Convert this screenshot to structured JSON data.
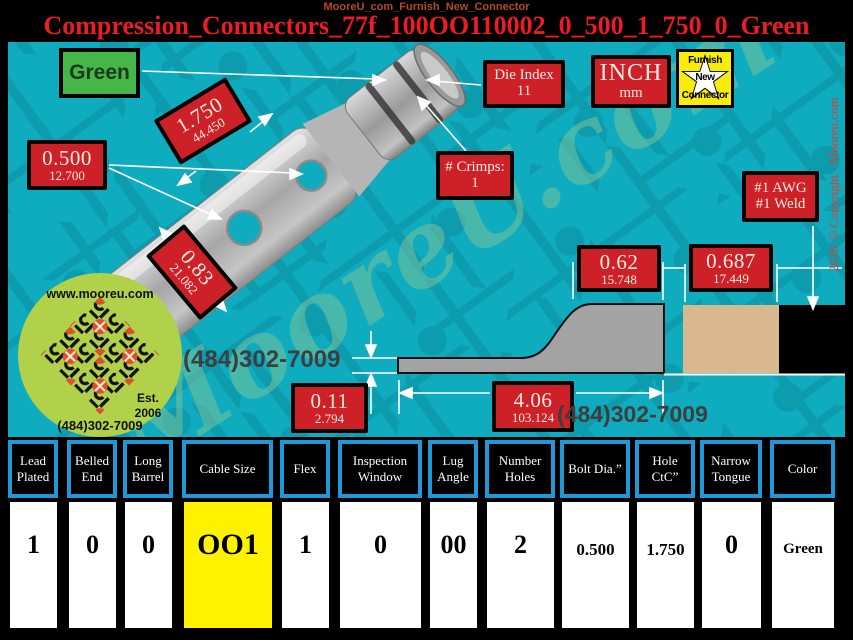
{
  "header": {
    "breadcrumb": "MooreU_com_Furnish_New_Connector",
    "title": "Compression_Connectors_77f_100OO110002_0_500_1_750_0_Green"
  },
  "canvas": {
    "green_button_label": "Green",
    "furnish_button": {
      "line1": "Furnish",
      "line2": "New",
      "line3": "Connector"
    },
    "labels": {
      "bolt_dia": {
        "in": "0.500",
        "mm": "12.700"
      },
      "hole_ctc": {
        "in": "1.750",
        "mm": "44.450"
      },
      "tongue_width": {
        "in": "0.83",
        "mm": "21.082"
      },
      "die_index": {
        "line1": "Die Index",
        "line2": "11"
      },
      "units": {
        "line1": "INCH",
        "line2": "mm"
      },
      "crimps": {
        "line1": "# Crimps:",
        "line2": "1"
      },
      "awg": {
        "line1": "#1 AWG",
        "line2": "#1 Weld"
      },
      "pad_height": {
        "in": "0.62",
        "mm": "15.748"
      },
      "barrel_od": {
        "in": "0.687",
        "mm": "17.449"
      },
      "tongue_thickness": {
        "in": "0.11",
        "mm": "2.794"
      },
      "overall_length": {
        "in": "4.06",
        "mm": "103.124"
      }
    },
    "phone1": "(484)302-7009",
    "phone2": "(484)302-7009",
    "watermark": "MooreU.com",
    "copyright": "2018 ©Copyright - Mooreu.com",
    "logo": {
      "url": "www.mooreu.com",
      "est": "Est.",
      "year": "2006",
      "phone": "(484)302-7009"
    }
  },
  "colors": {
    "canvas_teal": "#0fabbf",
    "label_red": "#ce2127",
    "title_red": "#ec1c24",
    "button_green": "#46b649",
    "highlight_yellow": "#fff200",
    "table_border_blue": "#1f98d8",
    "logo_green": "#b2d14b",
    "barrel_tan": "#d8b88c"
  },
  "table": {
    "columns": [
      {
        "label": "Lead Plated",
        "value": "1"
      },
      {
        "label": "Belled End",
        "value": "0"
      },
      {
        "label": "Long Barrel",
        "value": "0"
      },
      {
        "label": "Cable Size",
        "value": "OO1"
      },
      {
        "label": "Flex",
        "value": "1"
      },
      {
        "label": "Inspection Window",
        "value": "0"
      },
      {
        "label": "Lug Angle",
        "value": "00"
      },
      {
        "label": "Number Holes",
        "value": "2"
      },
      {
        "label": "Bolt Dia.”",
        "value": "0.500"
      },
      {
        "label": "Hole CtC”",
        "value": "1.750"
      },
      {
        "label": "Narrow Tongue",
        "value": "0"
      },
      {
        "label": "Color",
        "value": "Green"
      }
    ]
  }
}
